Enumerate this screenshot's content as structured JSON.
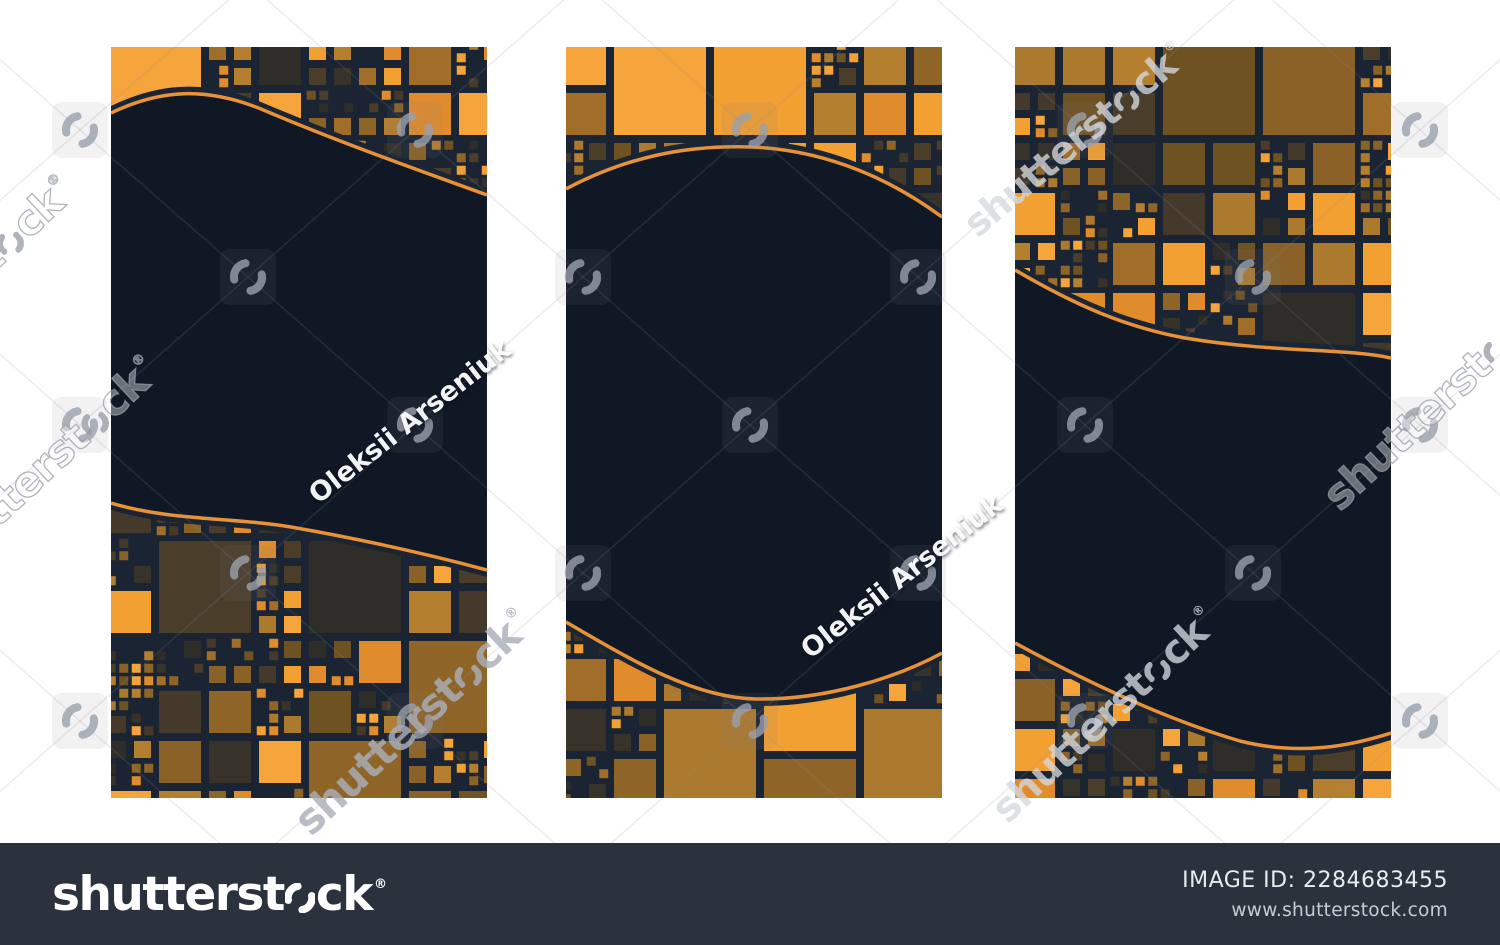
{
  "page": {
    "background": "#ffffff"
  },
  "artwork": {
    "description": "Set of three vertical banner templates with orange mosaic squares and navy wave areas",
    "panels": [
      {
        "name": "story-banner-1"
      },
      {
        "name": "story-banner-2"
      },
      {
        "name": "story-banner-3"
      }
    ],
    "colors": {
      "body_navy": "#101826",
      "mosaic_background": "#1B2433",
      "curve_orange": "#E89238",
      "mosaic_palette": [
        "#F5A53C",
        "#F2A032",
        "#E08C2D",
        "#B57F30",
        "#AC7A2E",
        "#A06E28",
        "#8F6527",
        "#8A6126",
        "#6E5222",
        "#4A3D2A",
        "#45392B",
        "#37332B",
        "#2F2D27"
      ]
    }
  },
  "watermark": {
    "brand_prefix": "shutterst",
    "brand_suffix": "ck",
    "registered_mark": "®",
    "contributor": "Oleksii Arseniuk",
    "icon_color": "#9AA1AC",
    "lattice_color": "rgba(140,146,156,0.16)"
  },
  "footer": {
    "background": "#2B323E",
    "logo_prefix": "shutterst",
    "logo_suffix": "ck",
    "registered_mark": "®",
    "image_id_label": "IMAGE ID:",
    "image_id": "2284683455",
    "website": "www.shutterstock.com"
  }
}
